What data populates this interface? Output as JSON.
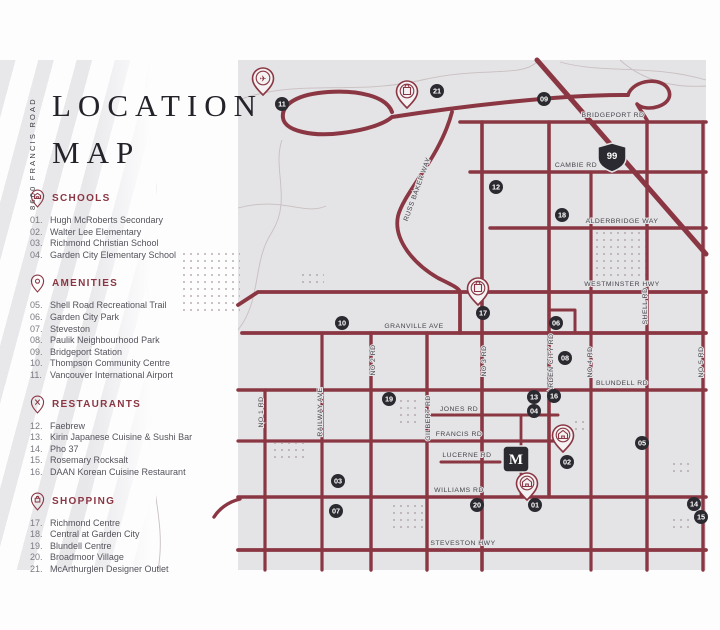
{
  "sidebar": {
    "vertical_label": "8600 FRANCIS ROAD",
    "title_line1": "LOCATION",
    "title_line2": "MAP",
    "sections": [
      {
        "id": "schools",
        "label": "SCHOOLS",
        "icon": "schools-pin-icon",
        "items": [
          {
            "num": "01.",
            "name": "Hugh McRoberts Secondary"
          },
          {
            "num": "02.",
            "name": "Walter Lee Elementary"
          },
          {
            "num": "03.",
            "name": "Richmond Christian School"
          },
          {
            "num": "04.",
            "name": "Garden City Elementary School"
          }
        ]
      },
      {
        "id": "amenities",
        "label": "AMENITIES",
        "icon": "amenities-pin-icon",
        "items": [
          {
            "num": "05.",
            "name": "Shell Road Recreational Trail"
          },
          {
            "num": "06.",
            "name": "Garden City Park"
          },
          {
            "num": "07.",
            "name": "Steveston"
          },
          {
            "num": "08.",
            "name": "Paulik Neighbourhood Park"
          },
          {
            "num": "09.",
            "name": "Bridgeport Station"
          },
          {
            "num": "10.",
            "name": "Thompson Community Centre"
          },
          {
            "num": "11.",
            "name": "Vancouver International Airport"
          }
        ]
      },
      {
        "id": "restaurants",
        "label": "RESTAURANTS",
        "icon": "restaurants-pin-icon",
        "items": [
          {
            "num": "12.",
            "name": "Faebrew"
          },
          {
            "num": "13.",
            "name": "Kirin Japanese Cuisine & Sushi Bar"
          },
          {
            "num": "14.",
            "name": "Pho 37"
          },
          {
            "num": "15.",
            "name": "Rosemary Rocksalt"
          },
          {
            "num": "16.",
            "name": "DAAN Korean Cuisine Restaurant"
          }
        ]
      },
      {
        "id": "shopping",
        "label": "SHOPPING",
        "icon": "shopping-pin-icon",
        "items": [
          {
            "num": "17.",
            "name": "Richmond Centre"
          },
          {
            "num": "18.",
            "name": "Central at Garden City"
          },
          {
            "num": "19.",
            "name": "Blundell Centre"
          },
          {
            "num": "20.",
            "name": "Broadmoor Village"
          },
          {
            "num": "21.",
            "name": "McArthurglen Designer Outlet"
          }
        ]
      }
    ]
  },
  "map": {
    "colors": {
      "road": "#8a3743",
      "map_bg": "#e4e3e5",
      "badge_bg": "#2b2a30",
      "badge_text": "#ffffff",
      "accent": "#8a3743"
    },
    "highway_shield": {
      "label": "99",
      "x": 612,
      "y": 157
    },
    "site_marker": {
      "label": "M",
      "x": 516,
      "y": 459
    },
    "road_labels": [
      {
        "text": "BRIDGEPORT RD",
        "x": 613,
        "y": 117,
        "r": 0
      },
      {
        "text": "CAMBIE RD",
        "x": 576,
        "y": 167,
        "r": 0
      },
      {
        "text": "ALDERBRIDGE WAY",
        "x": 622,
        "y": 223,
        "r": 0
      },
      {
        "text": "WESTMINSTER HWY",
        "x": 622,
        "y": 286,
        "r": 0
      },
      {
        "text": "GRANVILLE AVE",
        "x": 414,
        "y": 328,
        "r": 0
      },
      {
        "text": "BLUNDELL RD",
        "x": 622,
        "y": 385,
        "r": 0
      },
      {
        "text": "JONES RD",
        "x": 459,
        "y": 411,
        "r": 0
      },
      {
        "text": "FRANCIS RD",
        "x": 459,
        "y": 436,
        "r": 0
      },
      {
        "text": "LUCERNE RD",
        "x": 467,
        "y": 457,
        "r": 0
      },
      {
        "text": "WILLIAMS RD",
        "x": 459,
        "y": 492,
        "r": 0
      },
      {
        "text": "STEVESTON HWY",
        "x": 463,
        "y": 545,
        "r": 0
      },
      {
        "text": "RUSS BAKER WAY",
        "x": 419,
        "y": 190,
        "r": -70
      },
      {
        "text": "NO 1 RD",
        "x": 263,
        "y": 412,
        "r": -90
      },
      {
        "text": "RAILWAY AVE",
        "x": 322,
        "y": 412,
        "r": -90
      },
      {
        "text": "NO 2 RD",
        "x": 375,
        "y": 360,
        "r": -90
      },
      {
        "text": "GILBERT RD",
        "x": 430,
        "y": 418,
        "r": -90
      },
      {
        "text": "NO 3 RD",
        "x": 486,
        "y": 361,
        "r": -90
      },
      {
        "text": "GARDEN CITY RD",
        "x": 553,
        "y": 366,
        "r": -90
      },
      {
        "text": "NO 4 RD",
        "x": 592,
        "y": 362,
        "r": -90
      },
      {
        "text": "SHELL RD",
        "x": 647,
        "y": 306,
        "r": -90
      },
      {
        "text": "NO 5 RD",
        "x": 703,
        "y": 362,
        "r": -90
      }
    ],
    "badges": [
      {
        "n": "01",
        "x": 535,
        "y": 505
      },
      {
        "n": "02",
        "x": 567,
        "y": 462
      },
      {
        "n": "03",
        "x": 338,
        "y": 481
      },
      {
        "n": "04",
        "x": 534,
        "y": 411
      },
      {
        "n": "05",
        "x": 642,
        "y": 443
      },
      {
        "n": "06",
        "x": 556,
        "y": 323
      },
      {
        "n": "07",
        "x": 336,
        "y": 511
      },
      {
        "n": "08",
        "x": 565,
        "y": 358
      },
      {
        "n": "09",
        "x": 544,
        "y": 99
      },
      {
        "n": "10",
        "x": 342,
        "y": 323
      },
      {
        "n": "11",
        "x": 282,
        "y": 104
      },
      {
        "n": "12",
        "x": 496,
        "y": 187
      },
      {
        "n": "13",
        "x": 534,
        "y": 397
      },
      {
        "n": "14",
        "x": 694,
        "y": 504
      },
      {
        "n": "15",
        "x": 701,
        "y": 517
      },
      {
        "n": "16",
        "x": 554,
        "y": 396
      },
      {
        "n": "17",
        "x": 483,
        "y": 313
      },
      {
        "n": "18",
        "x": 562,
        "y": 215
      },
      {
        "n": "19",
        "x": 389,
        "y": 399
      },
      {
        "n": "20",
        "x": 477,
        "y": 505
      },
      {
        "n": "21",
        "x": 437,
        "y": 91
      }
    ],
    "pins": [
      {
        "type": "airplane",
        "x": 263,
        "y": 95
      },
      {
        "type": "bag",
        "x": 407,
        "y": 108
      },
      {
        "type": "bag",
        "x": 478,
        "y": 305
      },
      {
        "type": "school",
        "x": 563,
        "y": 452
      },
      {
        "type": "school",
        "x": 527,
        "y": 500
      }
    ]
  }
}
